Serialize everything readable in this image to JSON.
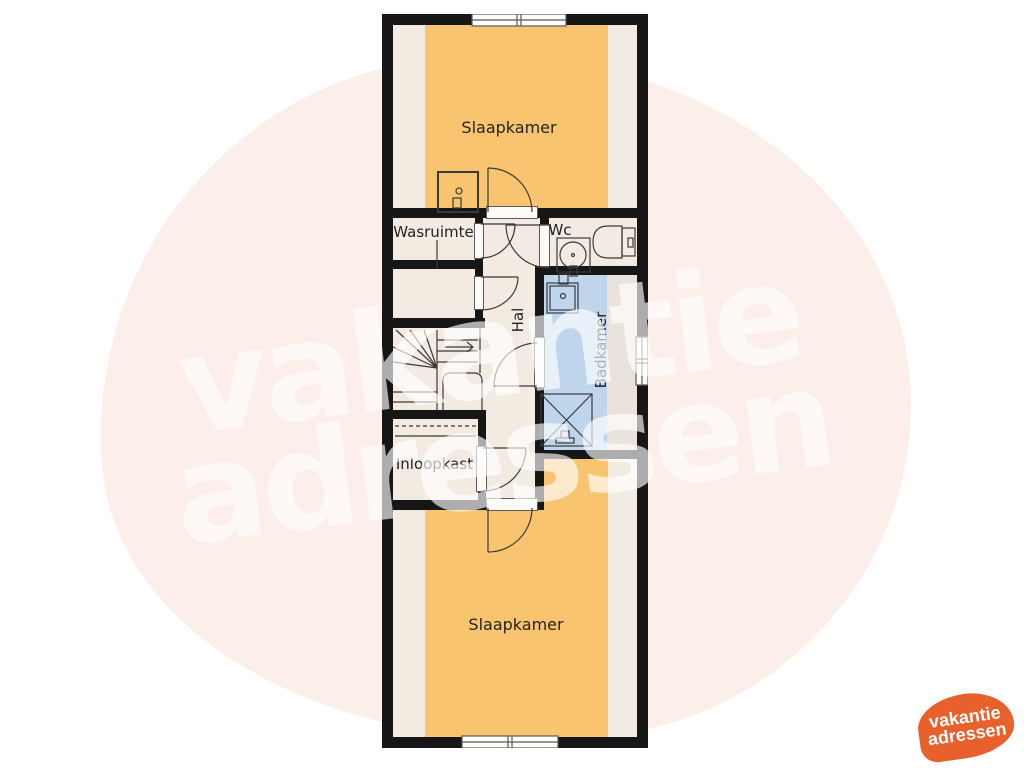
{
  "watermark": {
    "line1": "vakantie",
    "line2": "adressen"
  },
  "logo": {
    "line1": "vakantie",
    "line2": "adressen"
  },
  "rooms": {
    "bedroom_top": "Slaapkamer",
    "laundry": "Wasruimte",
    "wc": "Wc",
    "hall": "Hal",
    "bathroom": "Badkamer",
    "closet": "Inloopkast",
    "bedroom_bottom": "Slaapkamer"
  },
  "colors": {
    "wall": "#161616",
    "floor_cream": "#f3ebe2",
    "floor_orange": "#f9c46f",
    "floor_blue": "#bed5eb",
    "floor_blue_light": "#eae3db",
    "watermark_pink": "#fceee9",
    "watermark_text": "rgba(255,255,255,0.65)",
    "logo_orange": "#e8612c",
    "line": "#3a3a3a",
    "label_text": "#232323"
  }
}
